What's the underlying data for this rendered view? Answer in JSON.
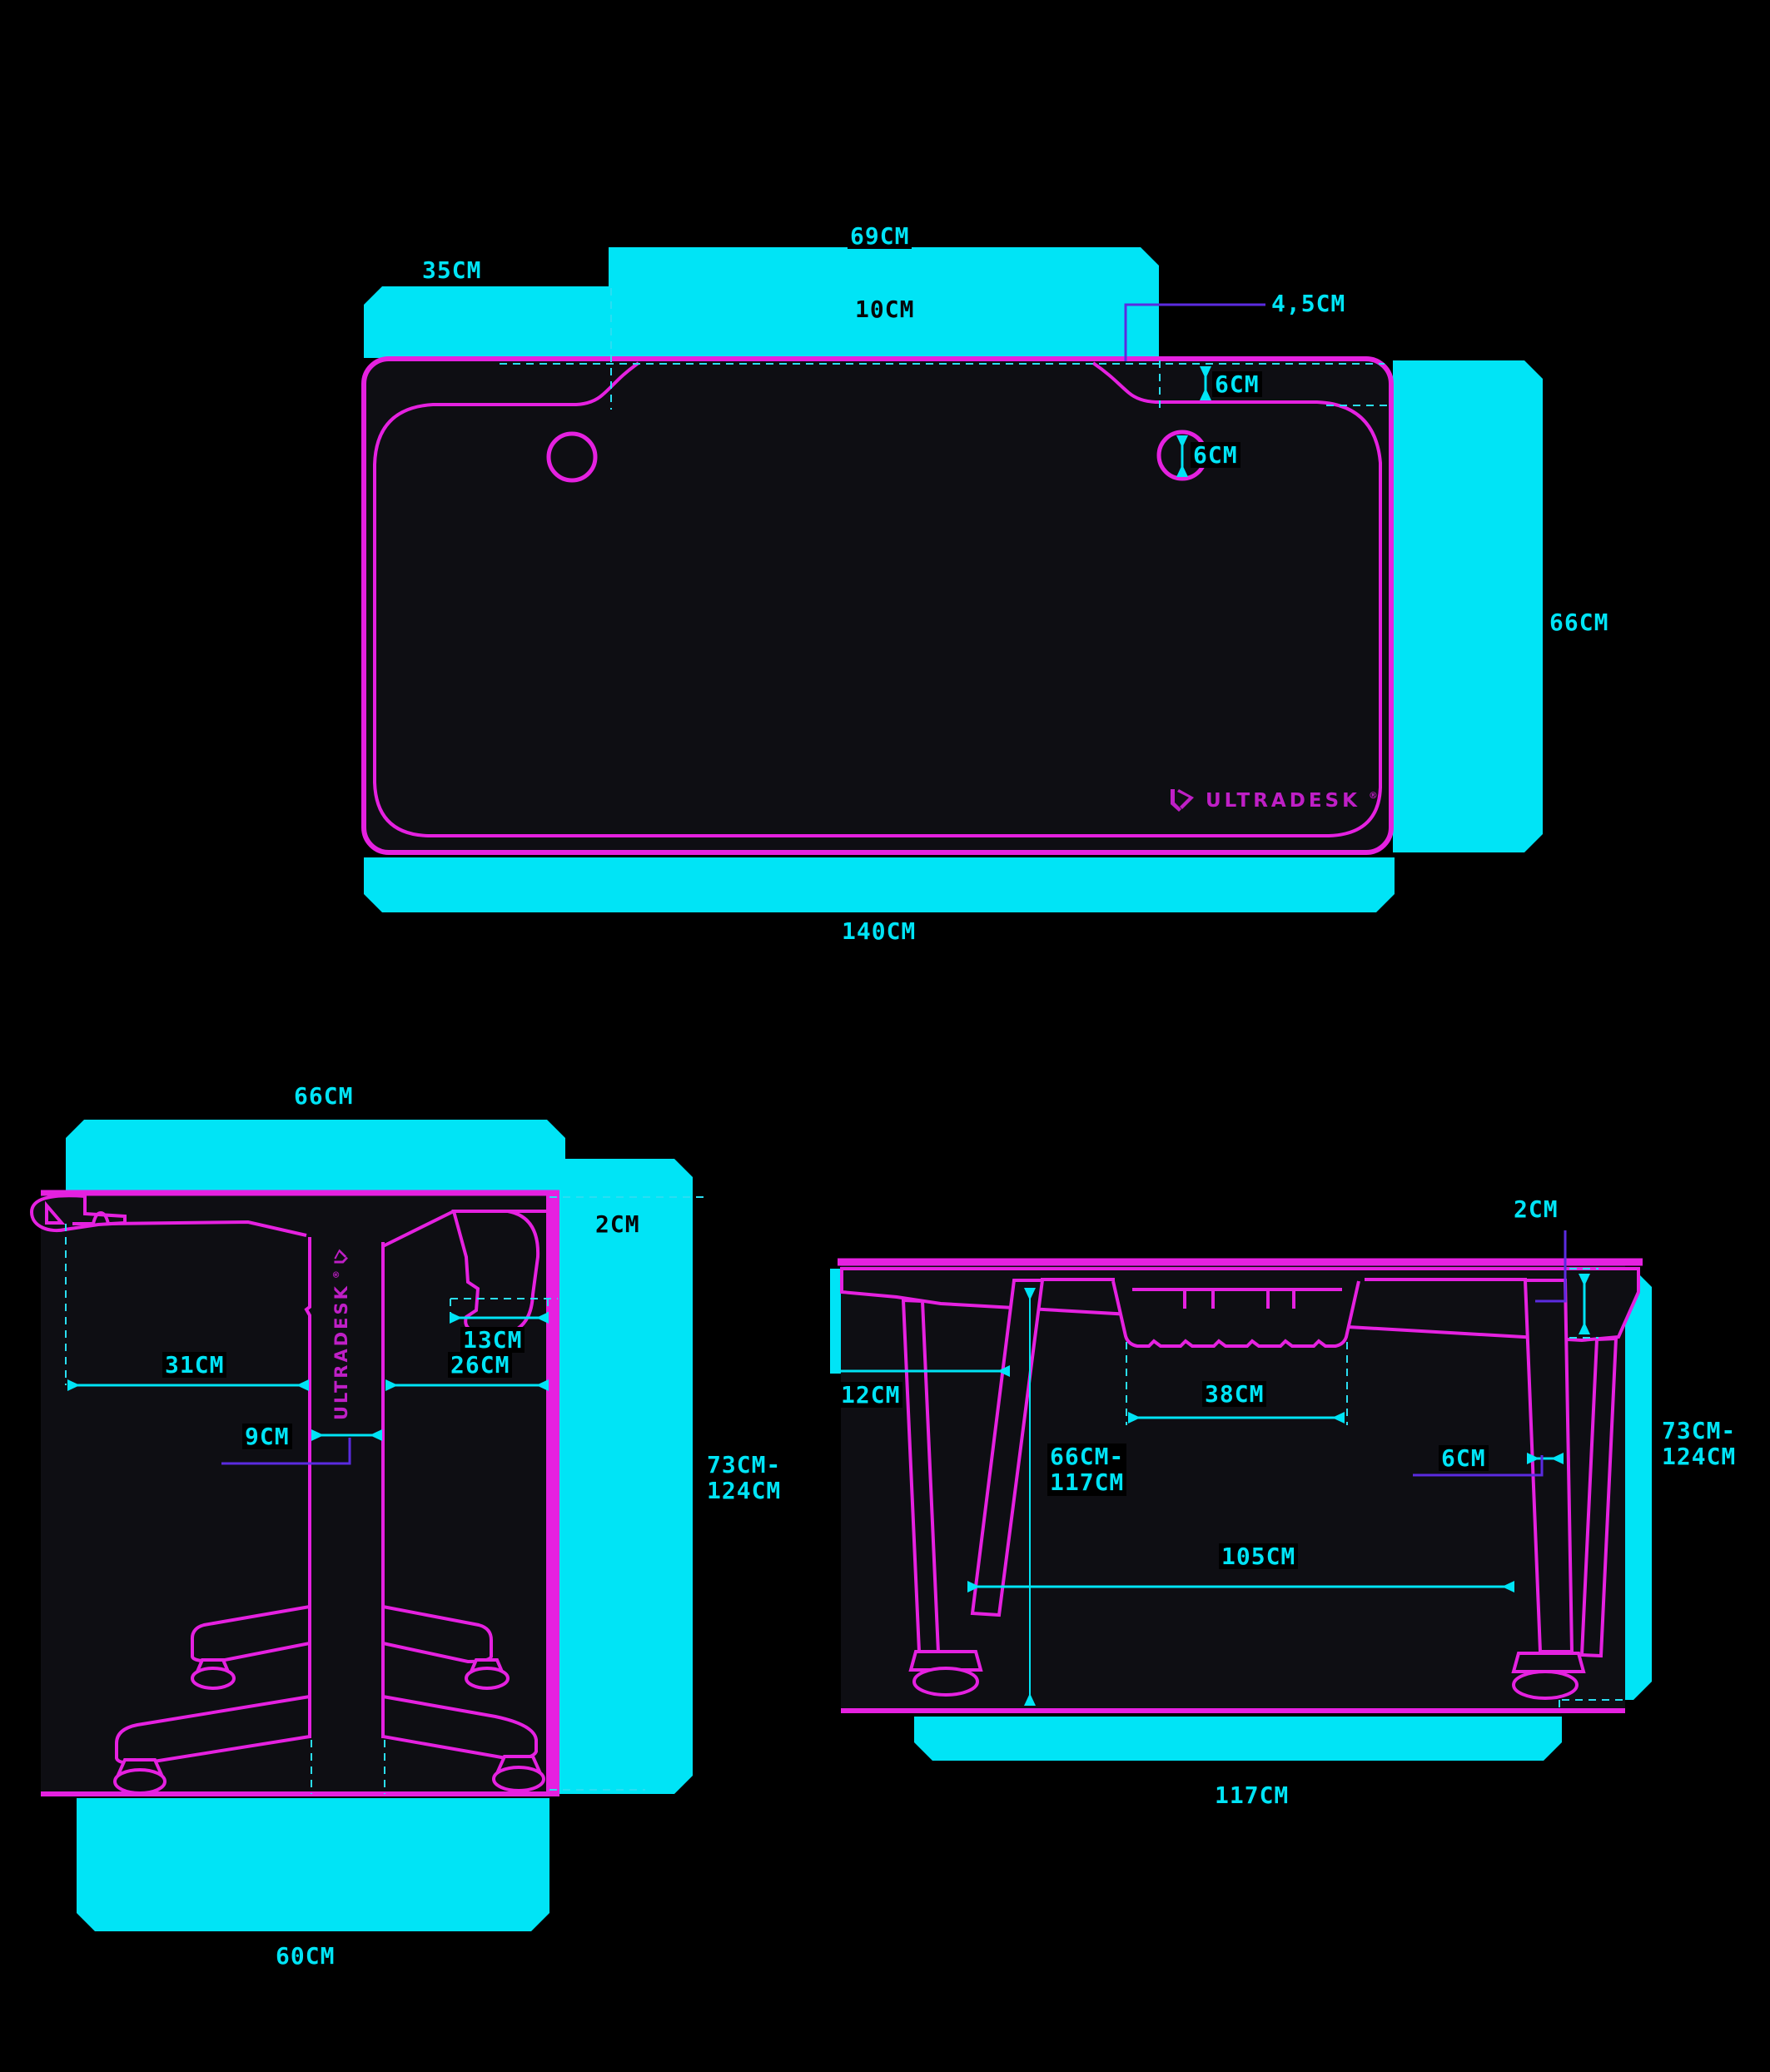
{
  "document": {
    "type": "desk-dimension-spec-sheet",
    "views": [
      "top-view",
      "side-view",
      "front-view"
    ]
  },
  "colors": {
    "background": "#000000",
    "panel_fill": "#0e0e13",
    "outline_magenta": "#e521e0",
    "brand_magenta": "#bf1fc6",
    "dimension_cyan": "#00e4f6",
    "leader_violet": "#5b2be0"
  },
  "labels": {
    "top_left_section": "35CM",
    "top_mid_section": "69CM",
    "top_mid_depth": "10CM",
    "top_corner": "4,5CM",
    "top_edge_inset": "6CM",
    "top_grommet": "6CM",
    "top_depth": "66CM",
    "top_width": "140CM",
    "side_depth": "66CM",
    "side_thickness": "2CM",
    "side_hook": "13CM",
    "side_front": "31CM",
    "side_rear": "26CM",
    "side_column": "9CM",
    "side_height_1": "73CM-",
    "side_height_2": "124CM",
    "side_base": "60CM",
    "front_thickness": "2CM",
    "front_overhang": "12CM",
    "front_tray": "38CM",
    "front_clearance_1": "66CM-",
    "front_clearance_2": "117CM",
    "front_leg": "6CM",
    "front_span": "105CM",
    "front_height_1": "73CM-",
    "front_height_2": "124CM",
    "front_width": "117CM"
  },
  "brand": {
    "name": "ULTRADESK",
    "registered": "®"
  }
}
